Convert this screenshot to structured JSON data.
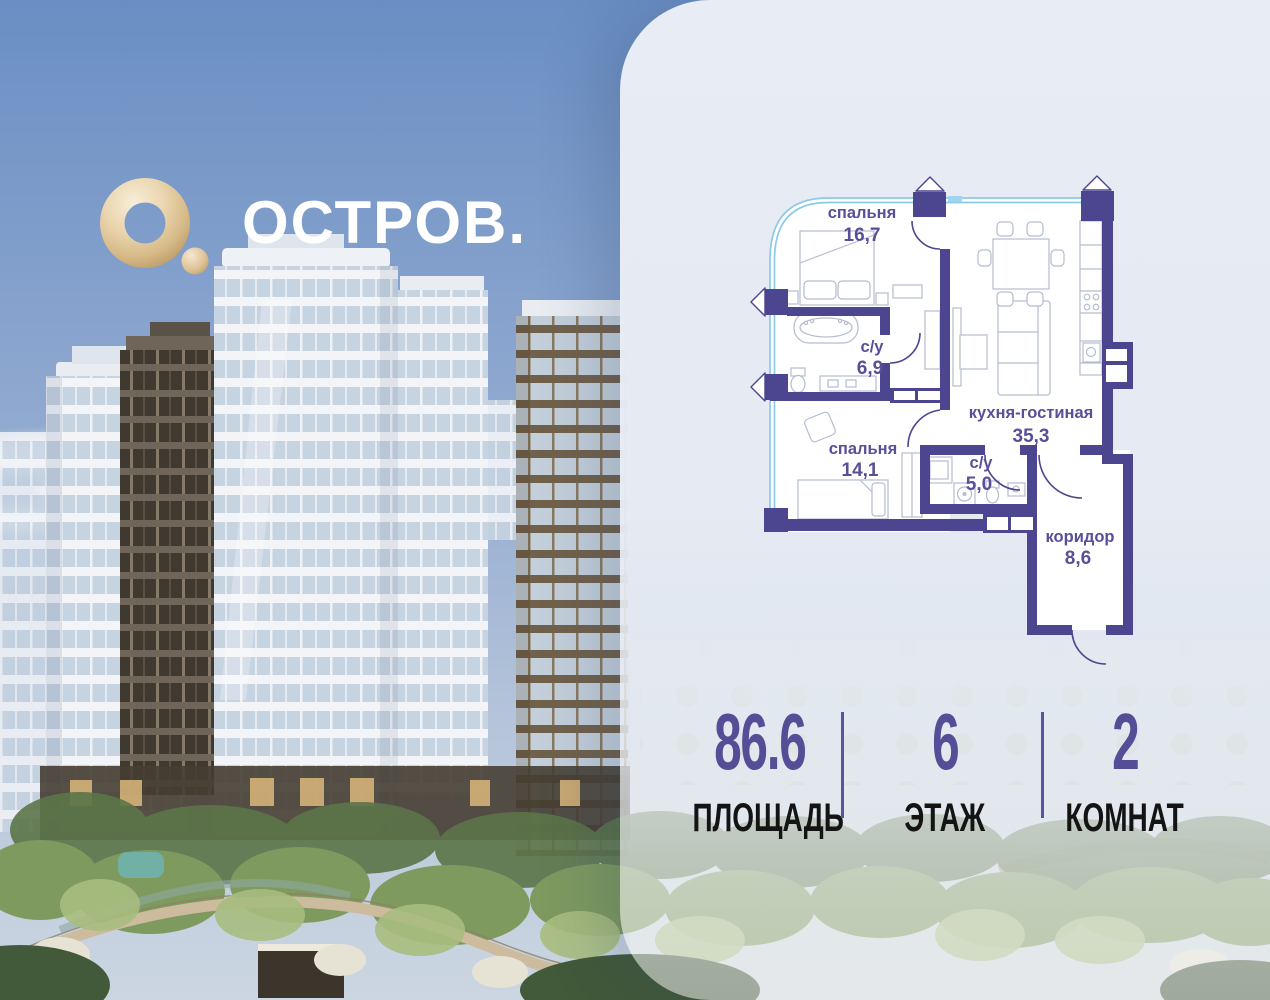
{
  "logo": {
    "brand": "ОСТРОВ."
  },
  "floorplan": {
    "rooms": {
      "bedroom1": {
        "name": "спальня",
        "area": "16,7"
      },
      "bath1": {
        "name": "с/у",
        "area": "6,9"
      },
      "kitchen": {
        "name": "кухня-гостиная",
        "area": "35,3"
      },
      "bedroom2": {
        "name": "спальня",
        "area": "14,1"
      },
      "bath2": {
        "name": "с/у",
        "area": "5,0"
      },
      "corridor": {
        "name": "коридор",
        "area": "8,6"
      }
    }
  },
  "stats": {
    "area": {
      "value": "86.6",
      "label": "ПЛОЩАДЬ"
    },
    "floor": {
      "value": "6",
      "label": "ЭТАЖ"
    },
    "rooms": {
      "value": "2",
      "label": "КОМНАТ"
    }
  },
  "colors": {
    "wall_purple": "#4c4590",
    "label_purple": "#575099",
    "stat_number_purple": "#554e96",
    "stat_label_black": "#141414",
    "divider_purple": "#5b53a0",
    "panel_background": "#e8ecf4",
    "window_glass_blue": "#8ccae6",
    "logo_gold": "#dcc094",
    "sky_blue": "#7e9cc8"
  }
}
